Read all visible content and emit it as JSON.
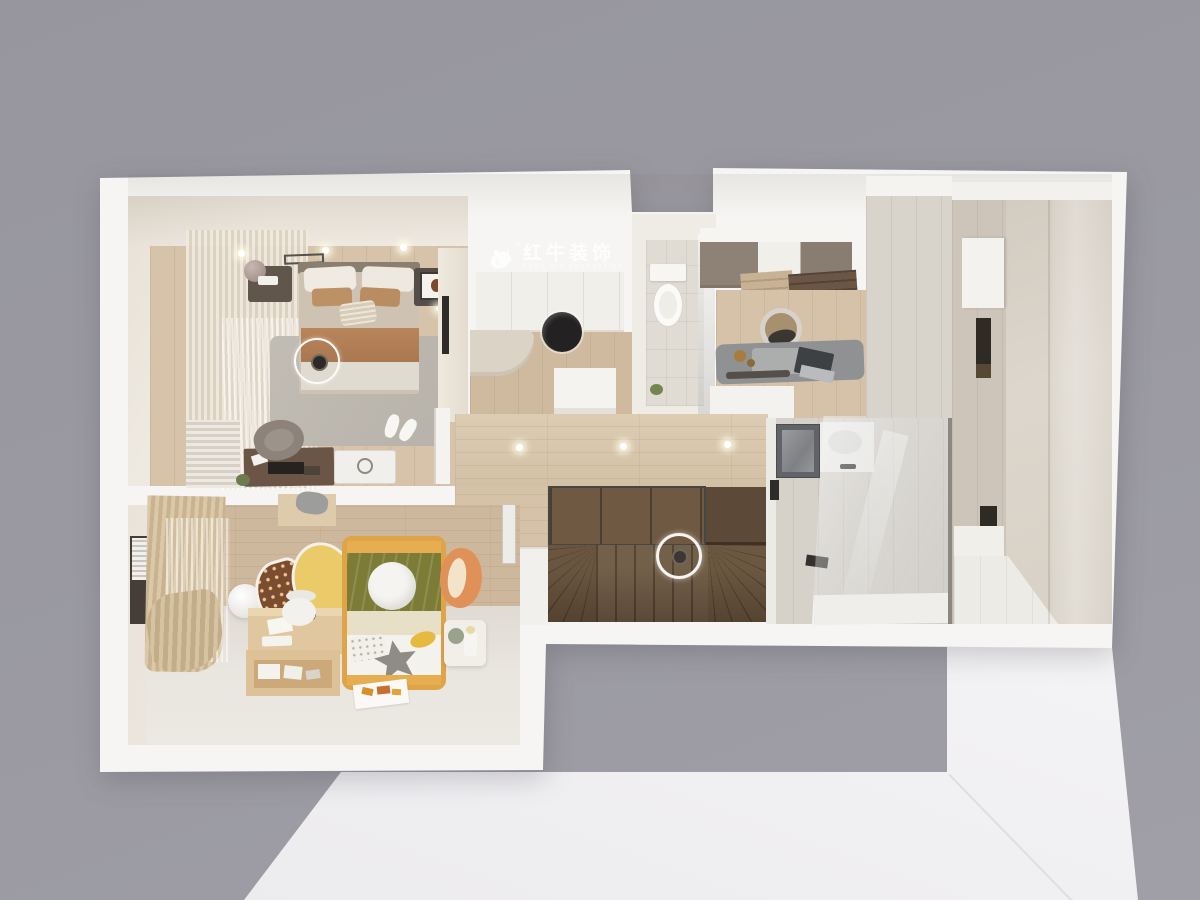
{
  "watermark": {
    "logo": "bull-icon",
    "registered_mark": "®",
    "brand": "红牛装饰",
    "tagline": "HONG NIU DECORATION"
  },
  "palette": {
    "background_gray": "#99989F",
    "platform_white": "#F0EFF1",
    "outer_wall_white": "#F6F5F3",
    "inner_wall_beige": "#EDE7DE",
    "bedroom_wood_floor": "#D5C2A9",
    "corridor_wood": "#D8C6AC",
    "stair_wood": "#6F5942",
    "stair_landing": "#5D4937",
    "stair_glass": "#A9AEB2",
    "bedroom_rug_gray": "#BCB7AF",
    "bed_throw_brown": "#B07E55",
    "bed_linen": "#E0DBD0",
    "kid_bed_frame_yellow": "#DFA348",
    "kid_blanket_green": "#7D7C36",
    "acorn_rug_yellow": "#EBCA69",
    "acorn_rug_brown": "#7C4C30",
    "fox_cushion_orange": "#E09158",
    "bath_tile_beige": "#DAD4CA",
    "bath_tile_gray": "#D6D1C9",
    "upper_cabinet_taupe": "#8E8176",
    "tea_desk_gray": "#8F9193",
    "dark_fixture": "#2E2C2A"
  }
}
